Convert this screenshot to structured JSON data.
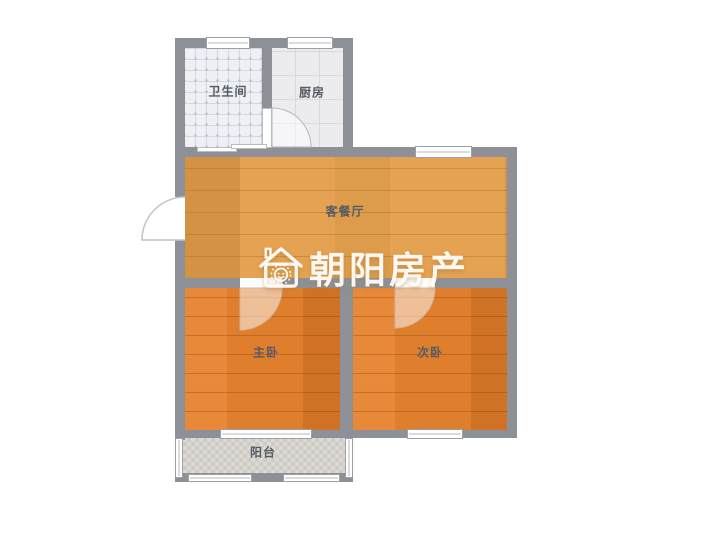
{
  "floorplan": {
    "brand": "朝阳房产",
    "rooms": {
      "bathroom": {
        "label": "卫生间"
      },
      "kitchen": {
        "label": "厨房"
      },
      "living": {
        "label": "客餐厅"
      },
      "master": {
        "label": "主卧"
      },
      "second": {
        "label": "次卧"
      },
      "balcony": {
        "label": "阳台"
      }
    },
    "colors": {
      "wall": "#8d9197",
      "living_floor": "#e4a252",
      "bedroom_floor": "#df7f2e",
      "bathroom_floor": "#eef0f4",
      "kitchen_floor": "#ececef",
      "balcony_floor": "#d8d5d1",
      "label_text": "#565b64",
      "watermark_text": "#ffffff"
    },
    "icons": {
      "logo": "house-logo-icon"
    }
  }
}
